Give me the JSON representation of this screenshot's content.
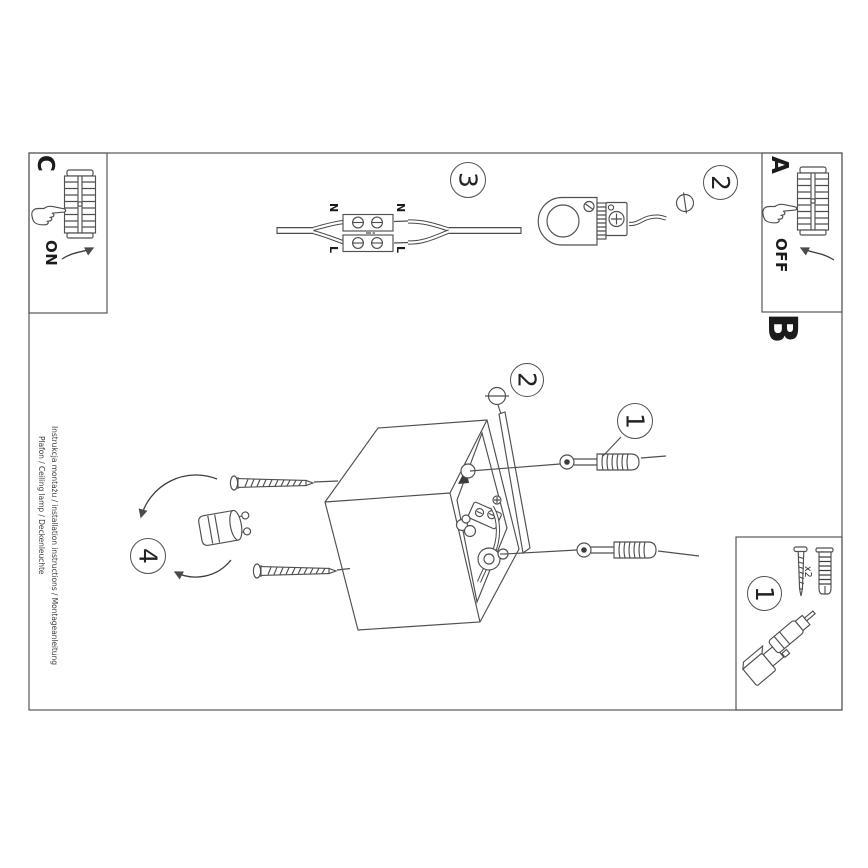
{
  "sheet": {
    "background": "#ffffff",
    "line_color": "#4f4f4f",
    "ink_color": "#3c3c3c",
    "text_color": "#1b1b1b"
  },
  "section_labels": {
    "a": "A",
    "b": "B",
    "c": "C"
  },
  "switch_labels": {
    "on": "ON",
    "off": "OFF"
  },
  "step_numbers": {
    "step1_parts_box": "1",
    "step1_anchor": "1",
    "step2_top": "2",
    "step2_cover": "2",
    "step3_wiring": "3",
    "step4_bulb": "4"
  },
  "wiring_labels": {
    "n_left": "N",
    "n_right": "N",
    "l_left": "L",
    "l_right": "L"
  },
  "parts": {
    "screw_plug_count": "x2"
  },
  "footer": {
    "line1": "Instrukcja montażu / installation instructions / Montageanleitung",
    "line2": "Plafon / Ceiling lamp / Deckenleuchte"
  }
}
